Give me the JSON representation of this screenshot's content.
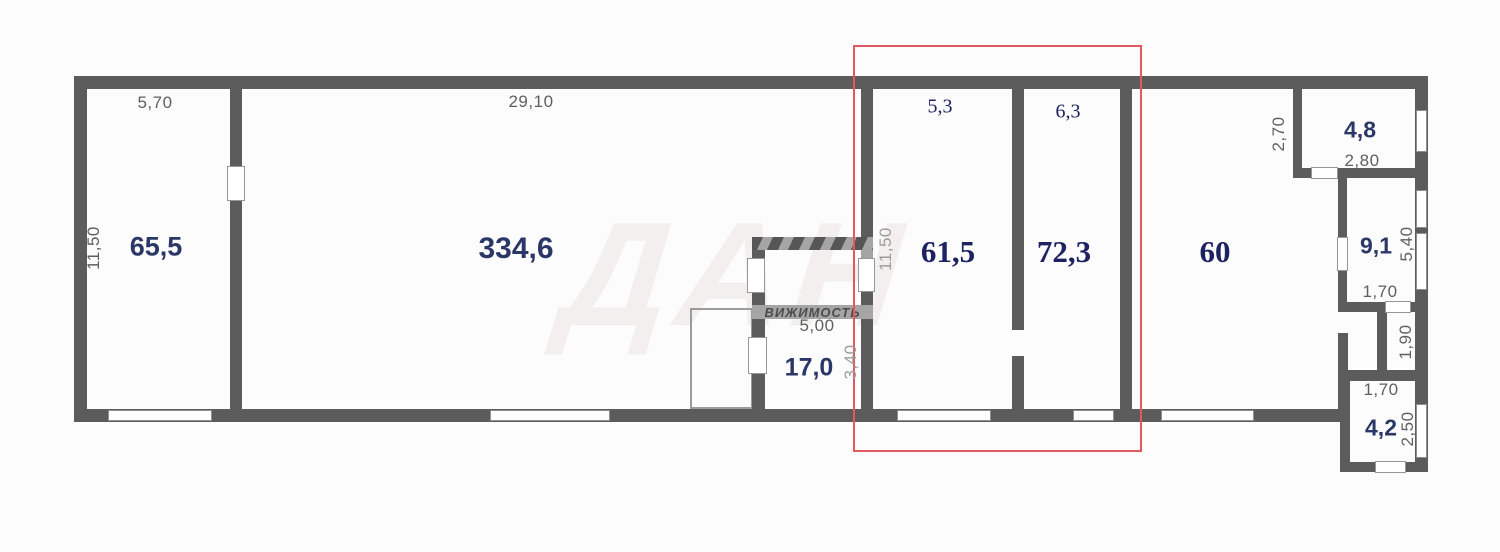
{
  "watermark": {
    "big": "ДАН",
    "band": "ВИЖИМОСТЬ"
  },
  "highlight": {
    "color": "#e0595c"
  },
  "rooms": [
    {
      "name": "hall-65",
      "area": "65,5",
      "dims": {
        "width": "5,70",
        "height": "11,50"
      }
    },
    {
      "name": "hall-334",
      "area": "334,6",
      "dims": {
        "width": "29,10"
      }
    },
    {
      "name": "annex-17",
      "area": "17,0",
      "dims": {
        "width": "5,00",
        "height": "3,40"
      }
    },
    {
      "name": "unit-61",
      "area": "61,5",
      "dims": {
        "width": "5,3",
        "height": "11,50"
      }
    },
    {
      "name": "unit-72",
      "area": "72,3",
      "dims": {
        "width": "6,3"
      }
    },
    {
      "name": "hall-60",
      "area": "60"
    },
    {
      "name": "room-4-8",
      "area": "4,8",
      "dims": {
        "width": "2,80",
        "height": "2,70"
      }
    },
    {
      "name": "room-9-1",
      "area": "9,1",
      "dims": {
        "width": "1,70",
        "height": "5,40"
      }
    },
    {
      "name": "room-1-9",
      "dims": {
        "height": "1,90"
      }
    },
    {
      "name": "room-4-2",
      "area": "4,2",
      "dims": {
        "width": "1,70",
        "height": "2,50"
      }
    }
  ]
}
